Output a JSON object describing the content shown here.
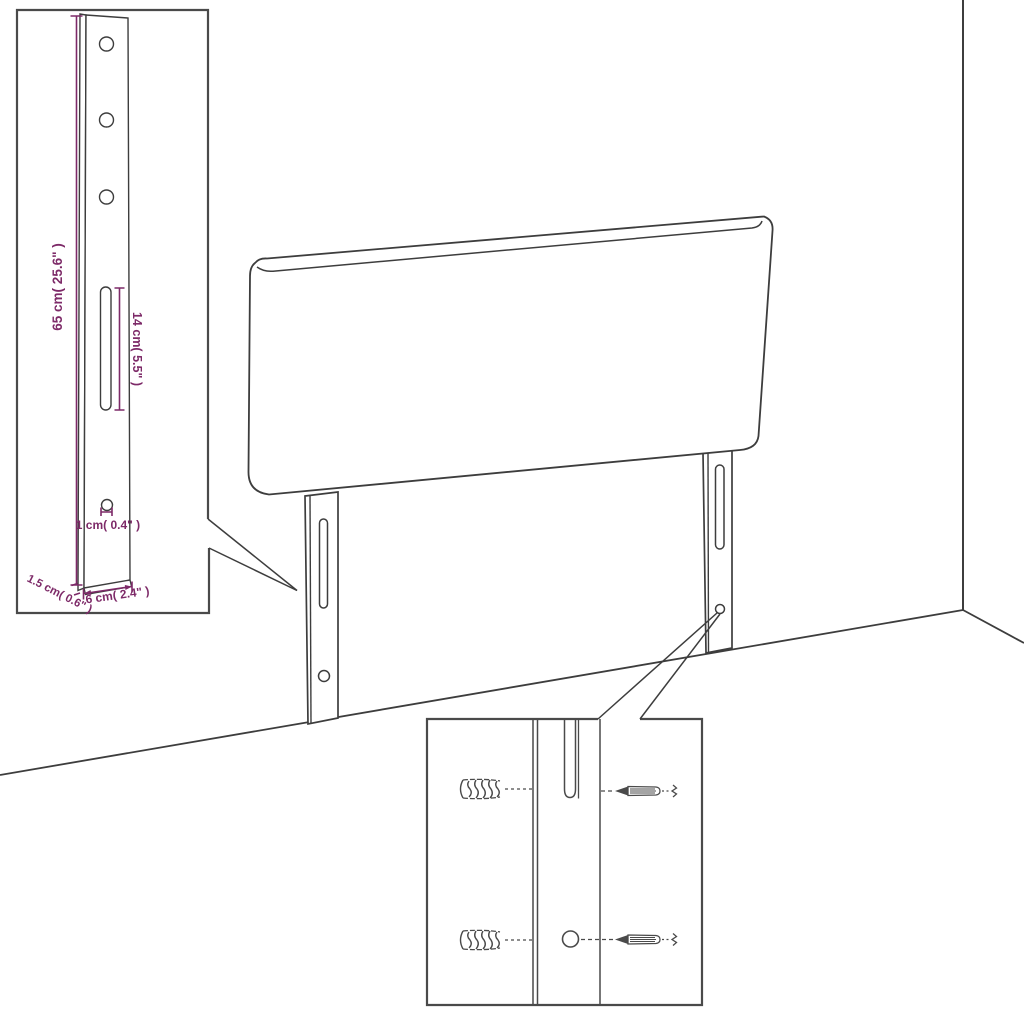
{
  "colors": {
    "accent": "#7D2A68",
    "line": "#3D3D3D",
    "background": "#FFFFFF"
  },
  "bracket_detail": {
    "leg_height": "65 cm( 25.6\" )",
    "slot_length": "14 cm( 5.5\" )",
    "hole_diameter": "1 cm( 0.4\" )",
    "side_depth": "1.5 cm( 0.6\" )",
    "leg_width": "6 cm( 2.4\" )"
  }
}
